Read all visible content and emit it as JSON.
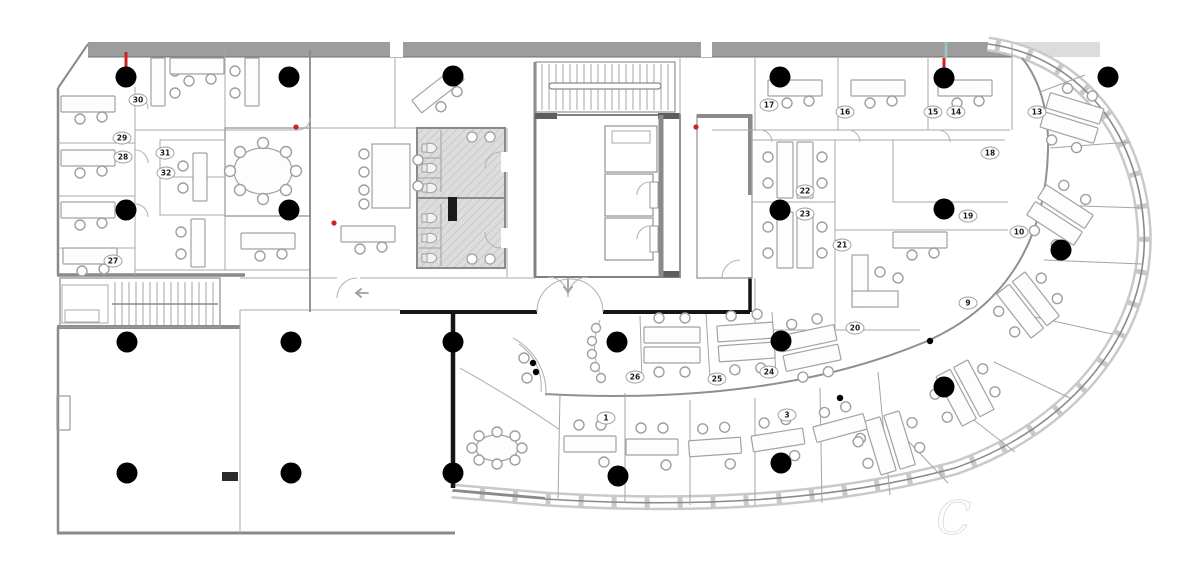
{
  "watermark": {
    "initial": "C"
  },
  "colors": {
    "sensor": "#000000",
    "alert": "#cc2222",
    "teal": "#9fc6bc",
    "wall": "#8a8a8a",
    "arrow": "#9aa0a0",
    "watermark": "#ffffff"
  },
  "sensors": [
    [
      126,
      77
    ],
    [
      289,
      77
    ],
    [
      453,
      76
    ],
    [
      780,
      77
    ],
    [
      944,
      78
    ],
    [
      1108,
      77
    ],
    [
      126,
      210
    ],
    [
      289,
      210
    ],
    [
      780,
      210
    ],
    [
      944,
      209
    ],
    [
      1061,
      250
    ],
    [
      127,
      342
    ],
    [
      291,
      342
    ],
    [
      453,
      342
    ],
    [
      617,
      342
    ],
    [
      781,
      341
    ],
    [
      944,
      387
    ],
    [
      127,
      473
    ],
    [
      291,
      473
    ],
    [
      453,
      473
    ],
    [
      618,
      476
    ],
    [
      781,
      463
    ]
  ],
  "mini_dots": [
    [
      533,
      363
    ],
    [
      536,
      372
    ],
    [
      840,
      398
    ],
    [
      930,
      341
    ]
  ],
  "red_ticks": [
    [
      126,
      52,
      126,
      70
    ],
    [
      944,
      58,
      944,
      72
    ]
  ],
  "teal_ticks": [
    [
      946,
      42,
      946,
      57
    ]
  ],
  "red_dots": [
    [
      296,
      127
    ],
    [
      334,
      223
    ],
    [
      696,
      127
    ]
  ],
  "arrows": [
    {
      "x": 355,
      "y": 293,
      "dir": "left"
    },
    {
      "x": 568,
      "y": 291,
      "dir": "down"
    }
  ],
  "room_labels": [
    {
      "n": "30",
      "x": 138,
      "y": 100
    },
    {
      "n": "29",
      "x": 122,
      "y": 138
    },
    {
      "n": "28",
      "x": 123,
      "y": 157
    },
    {
      "n": "31",
      "x": 165,
      "y": 153
    },
    {
      "n": "32",
      "x": 166,
      "y": 173
    },
    {
      "n": "27",
      "x": 113,
      "y": 261
    },
    {
      "n": "17",
      "x": 769,
      "y": 105
    },
    {
      "n": "16",
      "x": 845,
      "y": 112
    },
    {
      "n": "15",
      "x": 933,
      "y": 112
    },
    {
      "n": "14",
      "x": 956,
      "y": 112
    },
    {
      "n": "13",
      "x": 1037,
      "y": 112
    },
    {
      "n": "22",
      "x": 805,
      "y": 191
    },
    {
      "n": "23",
      "x": 805,
      "y": 214
    },
    {
      "n": "18",
      "x": 990,
      "y": 153
    },
    {
      "n": "19",
      "x": 968,
      "y": 216
    },
    {
      "n": "21",
      "x": 842,
      "y": 245
    },
    {
      "n": "10",
      "x": 1019,
      "y": 232
    },
    {
      "n": "9",
      "x": 968,
      "y": 303
    },
    {
      "n": "20",
      "x": 855,
      "y": 328
    },
    {
      "n": "26",
      "x": 635,
      "y": 377
    },
    {
      "n": "25",
      "x": 717,
      "y": 379
    },
    {
      "n": "24",
      "x": 769,
      "y": 372
    },
    {
      "n": "1",
      "x": 606,
      "y": 418
    },
    {
      "n": "3",
      "x": 787,
      "y": 415
    }
  ]
}
